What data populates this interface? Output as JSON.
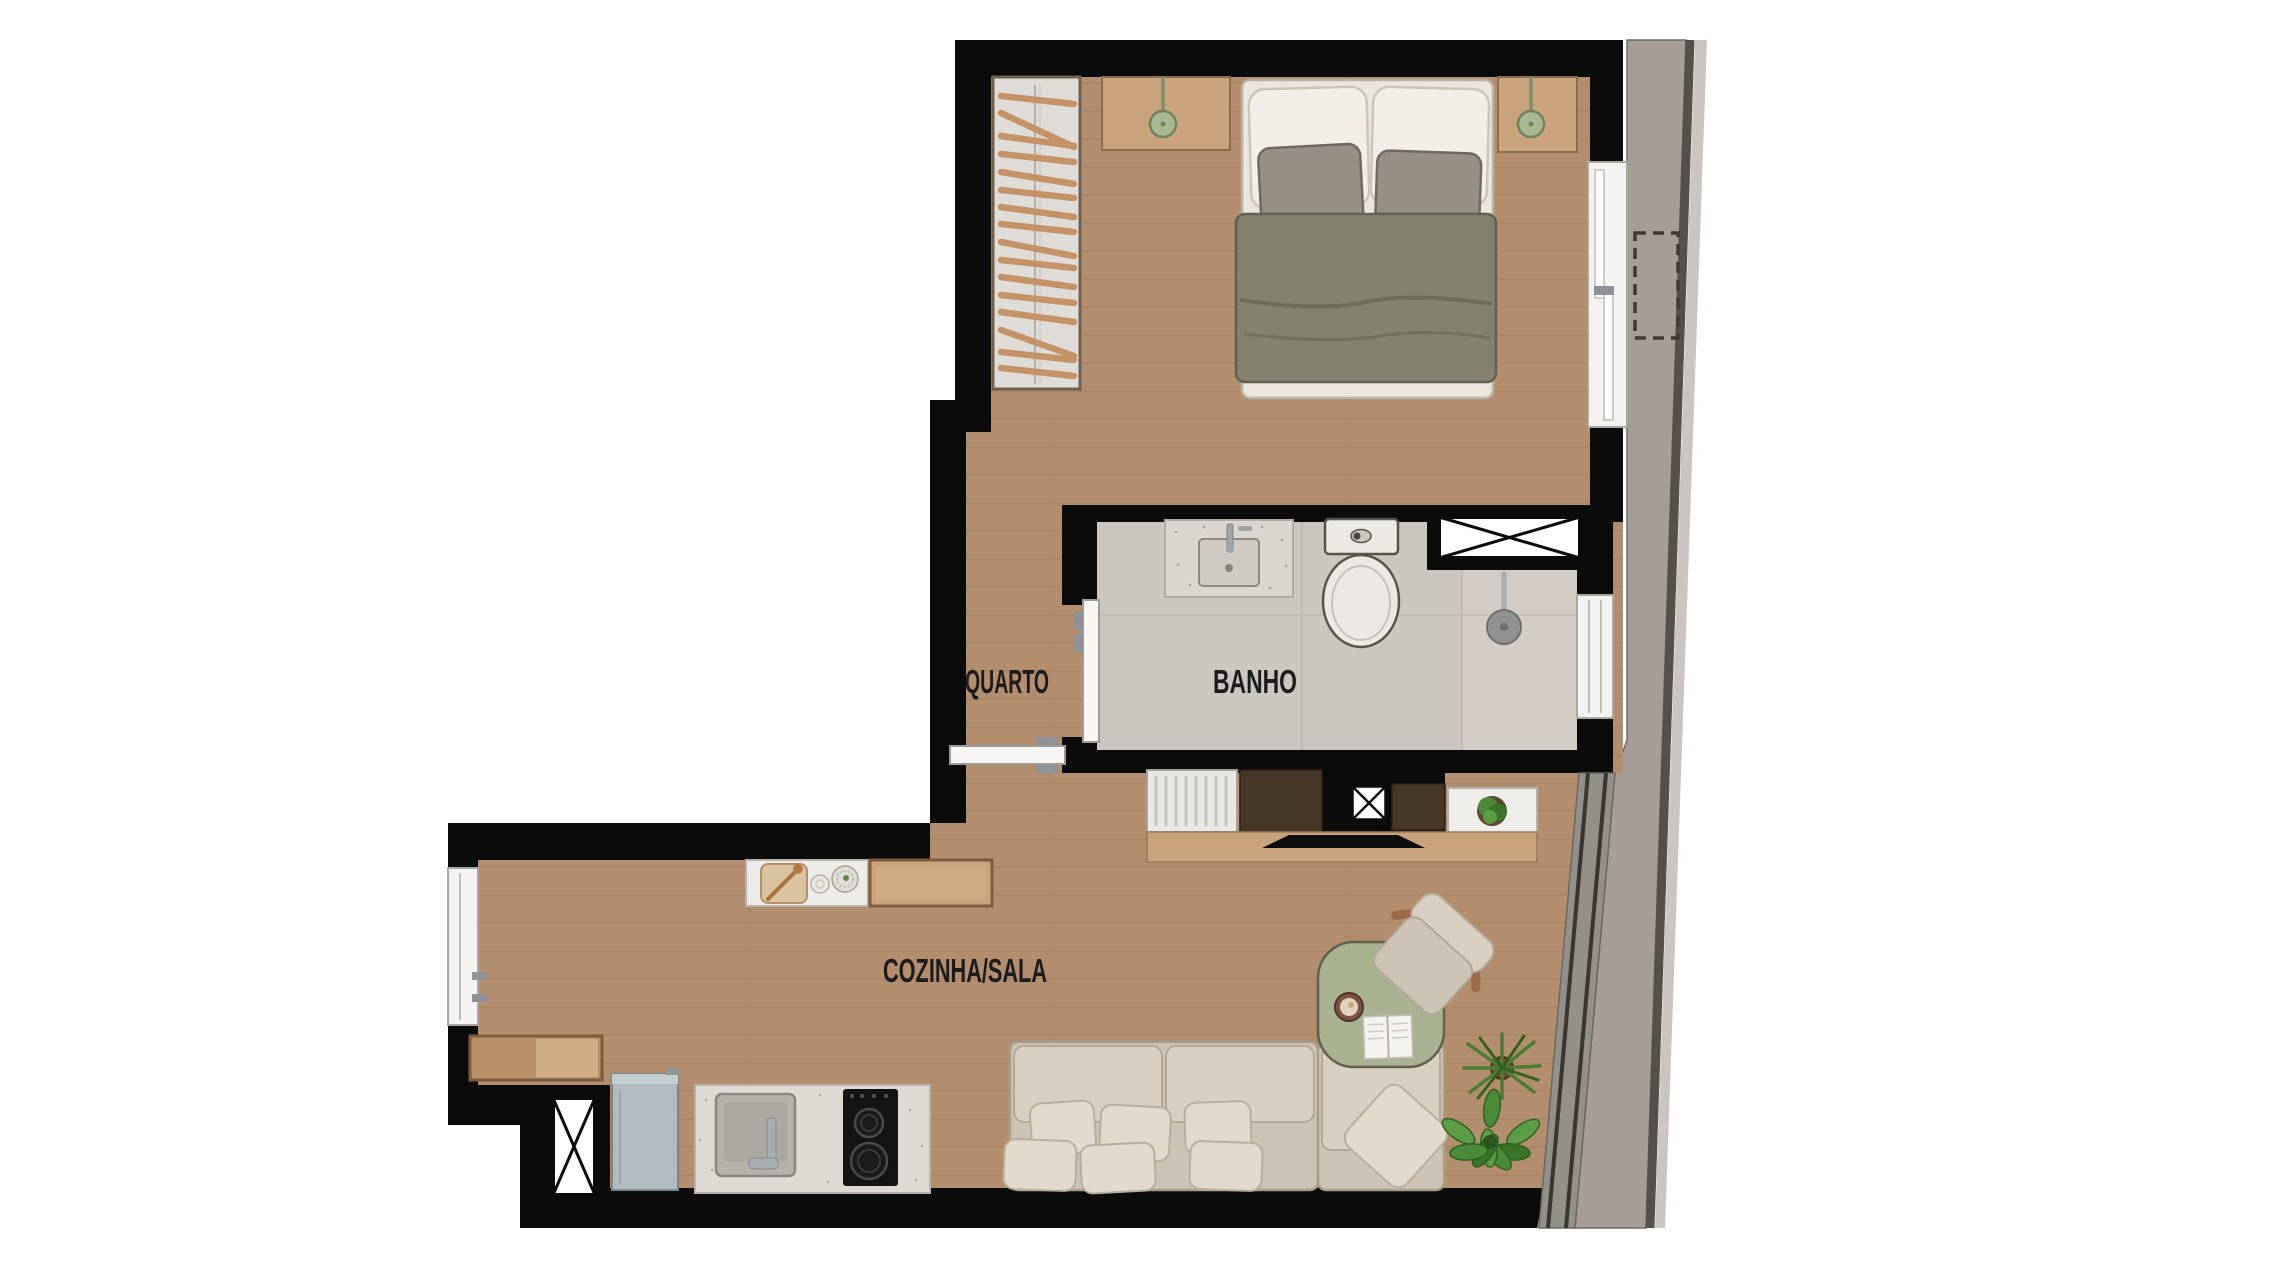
{
  "plan": {
    "type": "apartment-floor-plan",
    "rooms": [
      {
        "id": "quarto",
        "label": "QUARTO"
      },
      {
        "id": "banho",
        "label": "BANHO"
      },
      {
        "id": "cozinha_sala",
        "label": "COZINHA/SALA"
      }
    ]
  },
  "colors": {
    "background": "#ffffff",
    "wall": "#0b0b0b",
    "wood_floor": "#b28d6e",
    "tile_floor": "#ccc6c0",
    "tile_light": "#d3cdc6",
    "facade": "#a59d96",
    "facade_edge": "#54504b",
    "facade_light": "#cac5c0",
    "glass_band": "#938f89",
    "window_frame": "#f4f3f1",
    "wardrobe": "#dfdbd6",
    "hanger": "#c39367",
    "wood_furniture": "#c9a37d",
    "wood_dark_cabinet": "#463625",
    "bench_wood": "#b98f68",
    "mattress": "#eae6de",
    "pillow_white": "#f1eee8",
    "pillow_gray": "#968f83",
    "duvet": "#84826e",
    "sofa_base": "#cdc3b4",
    "sofa_cushion": "#d8cfc1",
    "sofa_pillow": "#e1d9cb",
    "table_sage": "#a9b290",
    "lamp_green": "#a9b893",
    "plant_green": "#4b8a38",
    "fridge_steel": "#b0bcbf",
    "counter_stone": "#dedad3",
    "cooktop_black": "#141414",
    "fixture_white": "#ece9e4",
    "chrome": "#a7adb1",
    "label_text": "#1c1c1c"
  }
}
